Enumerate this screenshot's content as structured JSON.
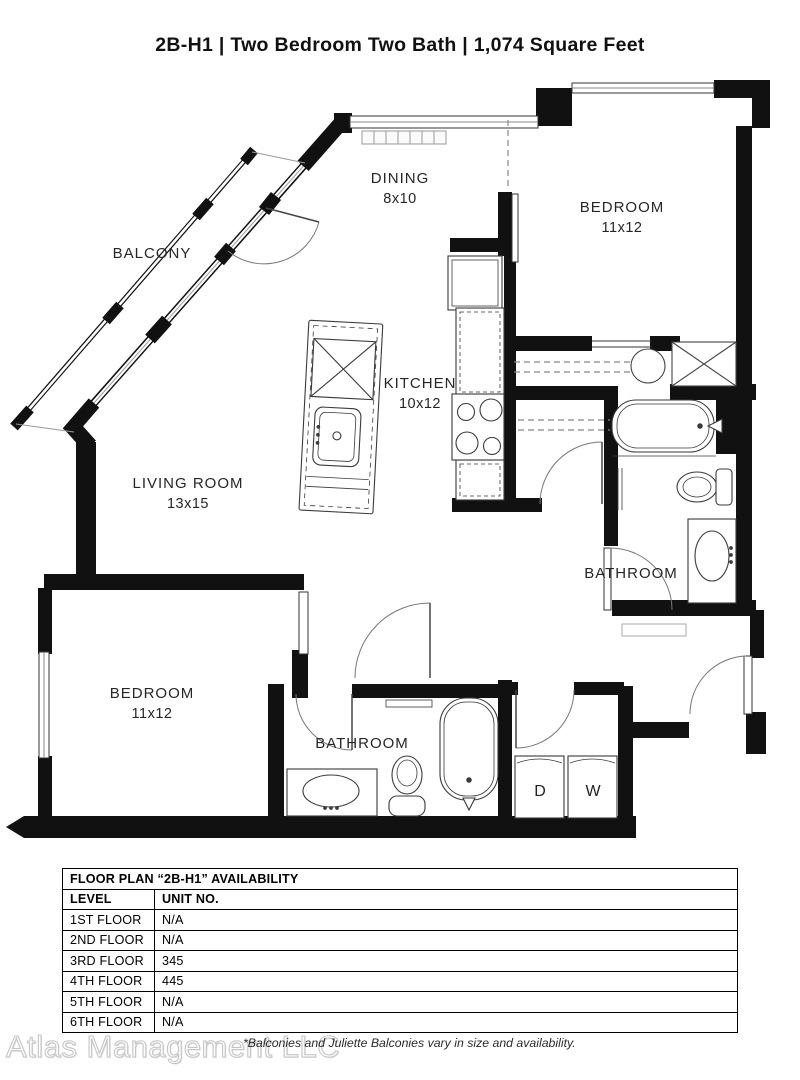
{
  "page": {
    "title": "2B-H1 | Two Bedroom Two Bath | 1,074 Square Feet"
  },
  "floor_plan": {
    "rooms": [
      {
        "name": "BALCONY",
        "dims": ""
      },
      {
        "name": "DINING",
        "dims": "8x10"
      },
      {
        "name": "BEDROOM",
        "dims": "11x12"
      },
      {
        "name": "KITCHEN",
        "dims": "10x12"
      },
      {
        "name": "LIVING ROOM",
        "dims": "13x15"
      },
      {
        "name": "BATHROOM",
        "dims": ""
      },
      {
        "name": "BEDROOM",
        "dims": "11x12"
      },
      {
        "name": "BATHROOM",
        "dims": ""
      }
    ],
    "appliances": {
      "dryer": "D",
      "washer": "W"
    }
  },
  "availability_table": {
    "title": "FLOOR PLAN “2B-H1” AVAILABILITY",
    "columns": [
      "LEVEL",
      "UNIT NO."
    ],
    "rows": [
      {
        "level": "1ST FLOOR",
        "unit": "N/A"
      },
      {
        "level": "2ND FLOOR",
        "unit": "N/A"
      },
      {
        "level": "3RD FLOOR",
        "unit": "345"
      },
      {
        "level": "4TH FLOOR",
        "unit": "445"
      },
      {
        "level": "5TH FLOOR",
        "unit": "N/A"
      },
      {
        "level": "6TH FLOOR",
        "unit": "N/A"
      }
    ]
  },
  "footer": {
    "watermark": "Atlas Management LLC",
    "note": "*Balconies and Juliette Balconies vary in size and availability."
  }
}
